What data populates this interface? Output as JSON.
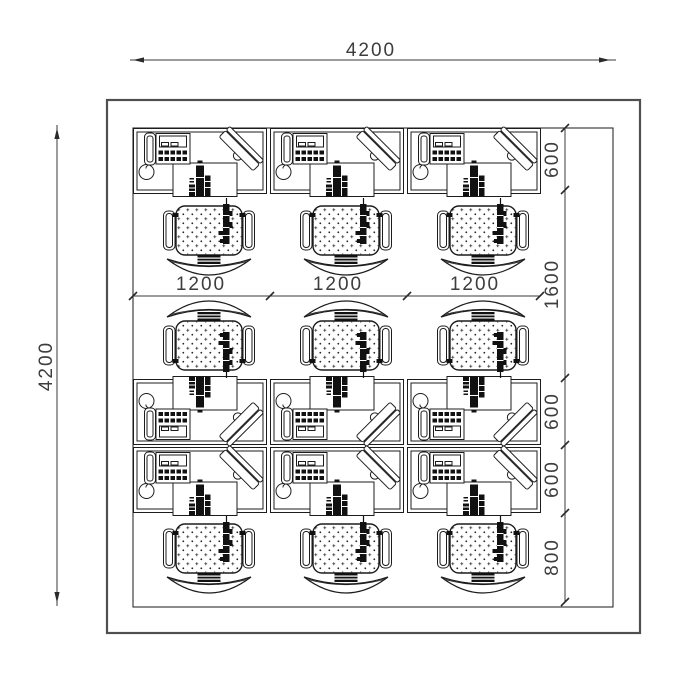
{
  "annotations": {
    "overall_width": {
      "label": "4200"
    },
    "overall_height": {
      "label": "4200"
    },
    "bay_widths": [
      {
        "label": "1200"
      },
      {
        "label": "1200"
      },
      {
        "label": "1200"
      }
    ],
    "right_chain": [
      {
        "label": "600"
      },
      {
        "label": "1600"
      },
      {
        "label": "600"
      },
      {
        "label": "600"
      },
      {
        "label": "800"
      }
    ]
  },
  "symbols": {
    "desk_unit": "desk-with-telephone-keyboard-monitor",
    "chair": "office-swivel-chair"
  },
  "counts": {
    "desk_units": 9,
    "chairs": 9
  },
  "colors": {
    "background": "#ffffff",
    "outer_wall": "#4f4f4f",
    "inner_boundary": "#2f2f2f",
    "furniture_line": "#1c1c1c",
    "dimension_line": "#3a3a3a",
    "dimension_text": "#3d3d3d"
  }
}
